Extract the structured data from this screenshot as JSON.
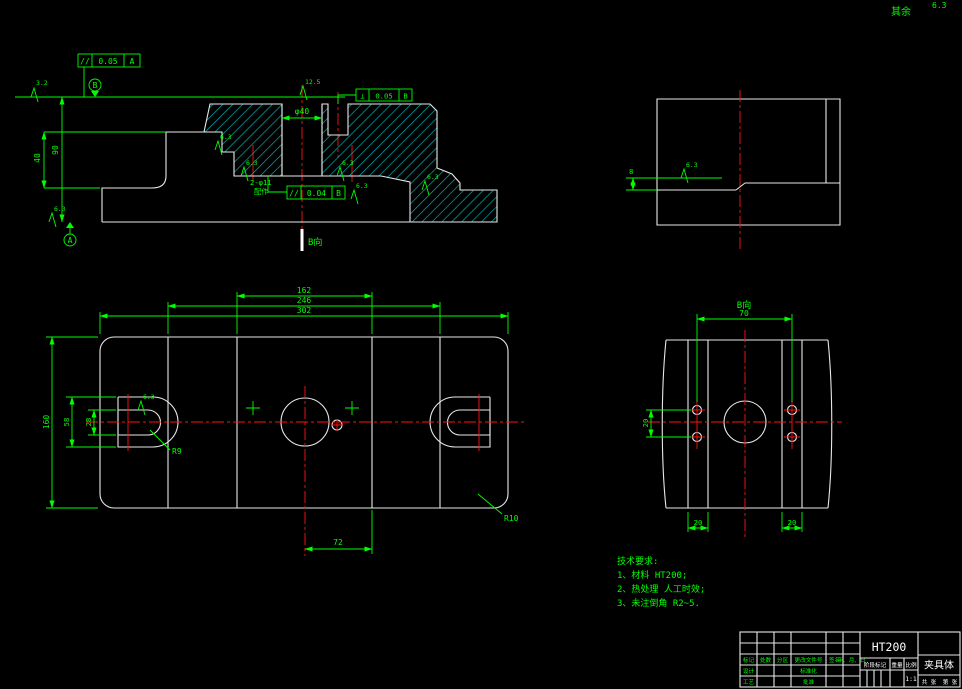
{
  "corner": {
    "label": "其余",
    "value": "6.3"
  },
  "front": {
    "view_marker": "B向",
    "dim_height": "90",
    "dim_step": "40",
    "dim_bore": "φ40",
    "holes_label_1": "2-φ11",
    "holes_label_2": "配作",
    "fcf1_sym": "//",
    "fcf1_tol": "0.05",
    "fcf1_datum": "A",
    "fcf2_sym": "⊥",
    "fcf2_tol": "0.05",
    "fcf2_datum": "B",
    "fcf3_sym": "//",
    "fcf3_tol": "0.04",
    "fcf3_datum": "B",
    "datum_top": "B",
    "datum_bottom": "A",
    "rough_1": "3.2",
    "rough_2": "12.5",
    "rough_gen": "6.3"
  },
  "side": {
    "dim_step": "8",
    "rough": "6.3"
  },
  "plan": {
    "dim_inner": "162",
    "dim_mid": "246",
    "dim_overall": "302",
    "dim_height": "160",
    "dim_slot": "58",
    "dim_slot_inner": "28",
    "dim_bottom": "72",
    "radius_slot": "R9",
    "radius_corner": "R10",
    "rough": "6.3"
  },
  "bview": {
    "label": "B向",
    "dim_top": "70",
    "dim_rows": "20",
    "dim_left": "20",
    "dim_right": "20"
  },
  "tech": {
    "title": "技术要求:",
    "items": [
      "1、材料 HT200;",
      "2、热处理 人工时效;",
      "3、未注倒角 R2~5."
    ]
  },
  "titleblock": {
    "material": "HT200",
    "part": "夹具体",
    "scale_value": "1:1",
    "cols": [
      "标记",
      "处数",
      "分区",
      "更改文件号",
      "签名",
      "年、月、日"
    ],
    "r_design": "设计",
    "r_std": "标准化",
    "r_proc": "工艺",
    "r_appr": "批准",
    "stage": "阶段标记",
    "weight": "重量",
    "scale": "比例",
    "sheets": "共 张",
    "sheet_no": "第 张"
  }
}
